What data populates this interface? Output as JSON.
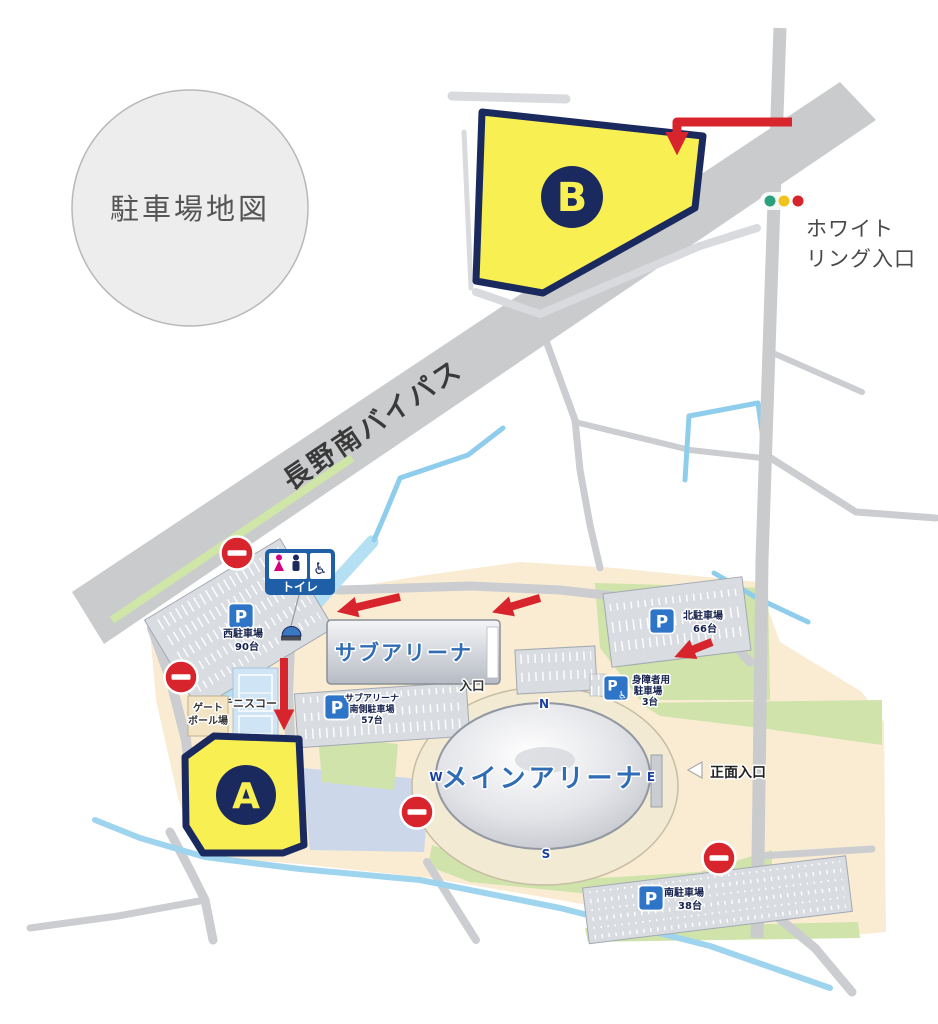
{
  "map_title": "駐車場地図",
  "roads": {
    "bypass_label": "長野南バイパス"
  },
  "signage": {
    "white_ring_entrance_line1": "ホワイト",
    "white_ring_entrance_line2": "リング入口",
    "front_entrance": "正面入口",
    "sub_arena_entrance": "入口",
    "toilet": "トイレ"
  },
  "zones": {
    "a": "A",
    "b": "B"
  },
  "buildings": {
    "sub_arena": "サブアリーナ",
    "main_arena": "メインアリーナ"
  },
  "compass": {
    "n": "N",
    "e": "E",
    "w": "W",
    "s": "S"
  },
  "facilities": {
    "tennis_court": "テニスコート",
    "gateball_line1": "ゲート",
    "gateball_line2": "ボール場"
  },
  "parking": {
    "symbol": "P",
    "west": {
      "name": "西駐車場",
      "capacity": "90台"
    },
    "north": {
      "name": "北駐車場",
      "capacity": "66台"
    },
    "south": {
      "name": "南駐車場",
      "capacity": "38台"
    },
    "sub_arena_south": {
      "line1": "サブアリーナ",
      "line2": "南側駐車場",
      "capacity": "57台"
    },
    "accessible": {
      "line1": "身障者用",
      "line2": "駐車場",
      "capacity": "3台"
    }
  },
  "icons": {
    "wheelchair": "♿"
  },
  "colors": {
    "zone_fill": "#f8ef53",
    "zone_border": "#1b2a5e",
    "route_red": "#d8242c",
    "road_gray": "#c9cbcd",
    "campus": "#f9ecd2",
    "green": "#cfe3ab",
    "water": "#a9d9f0",
    "parking_blue": "#2e75c8",
    "toilet_blue": "#1f5fa8",
    "arena_label": "#2f6cb3",
    "signal_green": "#2aa07c",
    "signal_yellow": "#f0c31e",
    "signal_red": "#d8242c"
  }
}
